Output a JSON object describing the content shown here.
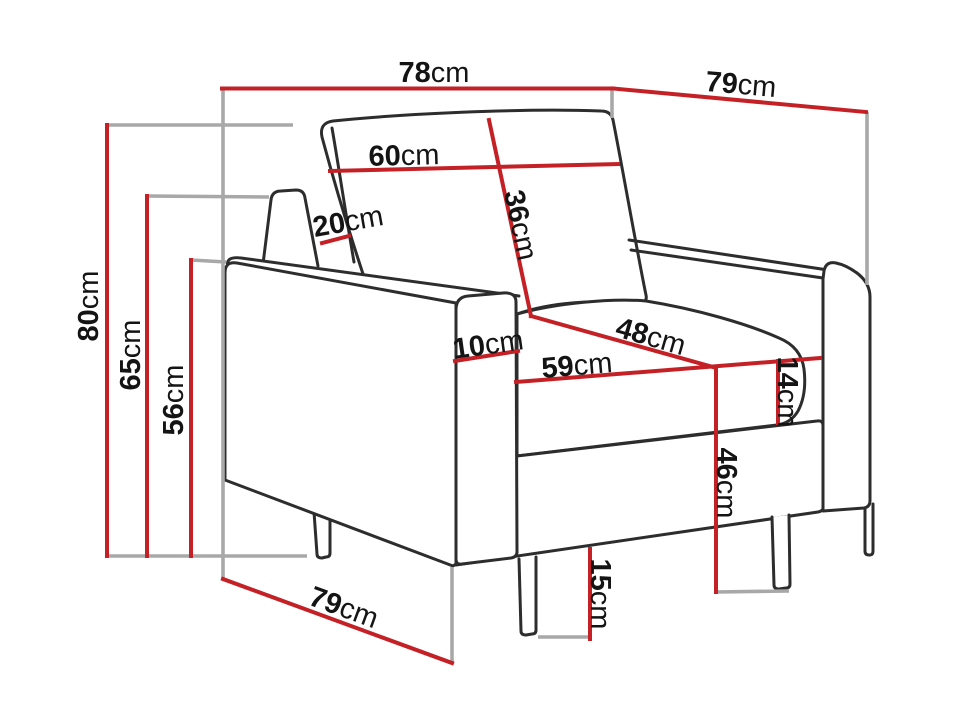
{
  "diagram": {
    "subject": "armchair dimension drawing",
    "unit_system": "metric"
  },
  "colors": {
    "dimension_line": "#c42127",
    "extension_line": "#a8a8a8",
    "outline": "#2d2d2d",
    "label_text": "#141414",
    "background": "#ffffff"
  },
  "dimensions": [
    {
      "id": "overall-width",
      "value": "78",
      "unit": "cm"
    },
    {
      "id": "overall-depth-top",
      "value": "79",
      "unit": "cm"
    },
    {
      "id": "backrest-cushion-width",
      "value": "60",
      "unit": "cm"
    },
    {
      "id": "side-back-panel-width",
      "value": "20",
      "unit": "cm"
    },
    {
      "id": "backrest-cushion-height",
      "value": "36",
      "unit": "cm"
    },
    {
      "id": "overall-height",
      "value": "80",
      "unit": "cm"
    },
    {
      "id": "back-height",
      "value": "65",
      "unit": "cm"
    },
    {
      "id": "armrest-height",
      "value": "56",
      "unit": "cm"
    },
    {
      "id": "armrest-width",
      "value": "10",
      "unit": "cm"
    },
    {
      "id": "seat-depth",
      "value": "48",
      "unit": "cm"
    },
    {
      "id": "seat-width",
      "value": "59",
      "unit": "cm"
    },
    {
      "id": "seat-cushion-thickness",
      "value": "14",
      "unit": "cm"
    },
    {
      "id": "seat-height",
      "value": "46",
      "unit": "cm"
    },
    {
      "id": "leg-height",
      "value": "15",
      "unit": "cm"
    },
    {
      "id": "overall-depth-bottom",
      "value": "79",
      "unit": "cm"
    }
  ]
}
